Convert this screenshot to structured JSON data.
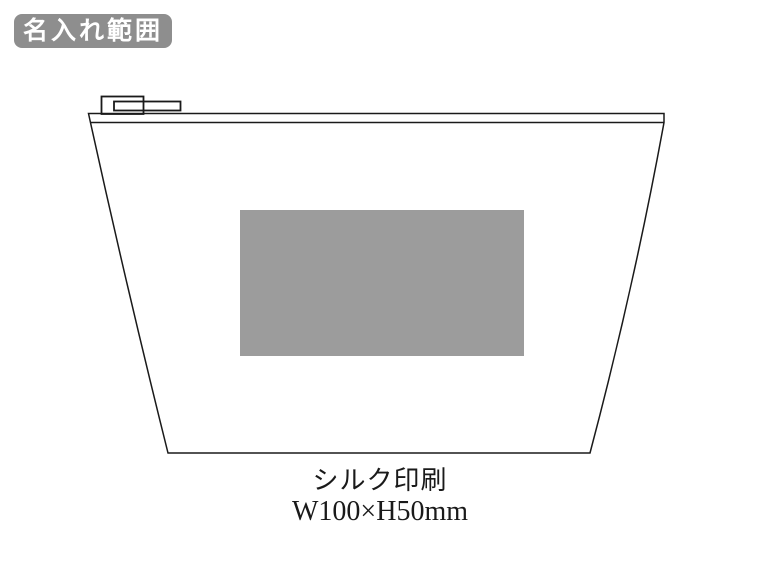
{
  "badge": {
    "label": "名入れ範囲",
    "bg_color": "#8e8e8e",
    "text_color": "#ffffff"
  },
  "drawing": {
    "subject": "zippered-pouch-line-drawing",
    "stroke_color": "#1a1a1a",
    "background_color": "#ffffff",
    "print_area": {
      "fill_color": "#9c9c9c"
    }
  },
  "caption": {
    "method": "シルク印刷",
    "size": "W100×H50mm"
  }
}
